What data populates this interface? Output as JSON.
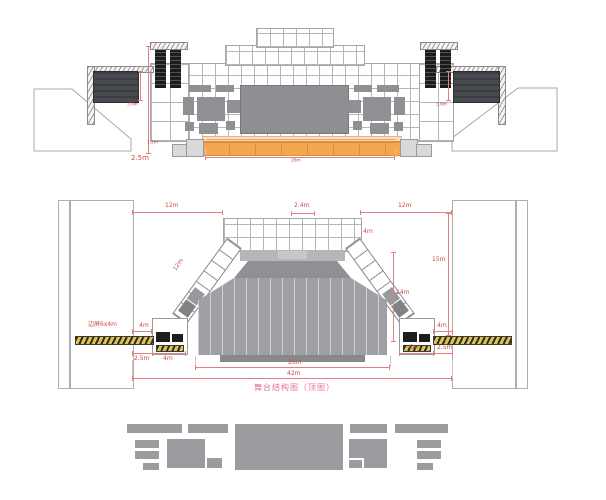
{
  "diagram": {
    "caption": "舞台结构图（顶图）"
  },
  "elevation": {
    "dim_left_offset": "2.5m",
    "dim_side_screen_left": "3.6m",
    "dim_side_screen_right": "3.6m",
    "dim_stage_height": "1.2m",
    "dim_stage_width": "26m"
  },
  "plan": {
    "dim_top_left": "12m",
    "dim_top_center": "2.4m",
    "dim_top_right": "12m",
    "dim_diagonal_truss": "12m",
    "dim_right_gap": "4m",
    "dim_right_side_height": "15m",
    "dim_right_truss_height": "14m",
    "side_screen_label": "边屏6x4m",
    "dim_left_hatch": "4m",
    "dim_right_hatch": "4m",
    "dim_bottom_left_gap": "2.5m",
    "dim_bottom_left_box": "4m",
    "dim_bottom_right_box": "6m",
    "dim_bottom_right_gap": "2.5m",
    "dim_stage_width": "26m",
    "dim_total_width": "42m"
  },
  "colors": {
    "dimension_red": "#cc4a4a",
    "caption_pink": "#e8708e",
    "stage_orange": "#f3a74f",
    "equipment_gray": "#8e9093",
    "footer_gray": "#9b9ca0",
    "hatch_yellow": "#ddc34a"
  }
}
